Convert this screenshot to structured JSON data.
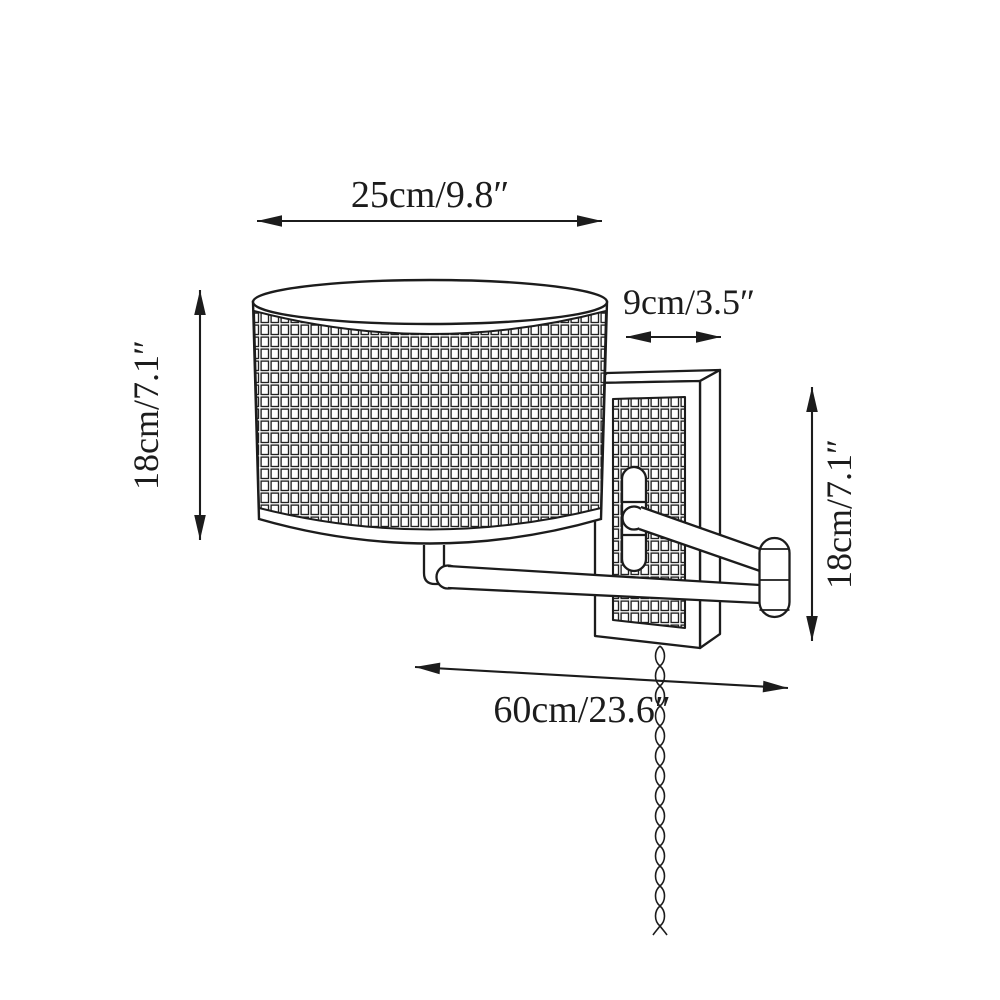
{
  "canvas": {
    "background": "#ffffff",
    "line_color": "#1c1c1c"
  },
  "labels": {
    "shade_width": "25cm/9.8″",
    "shade_height": "18cm/7.1″",
    "plate_width": "9cm/3.5″",
    "plate_height": "18cm/7.1″",
    "extension": "60cm/23.6″"
  }
}
